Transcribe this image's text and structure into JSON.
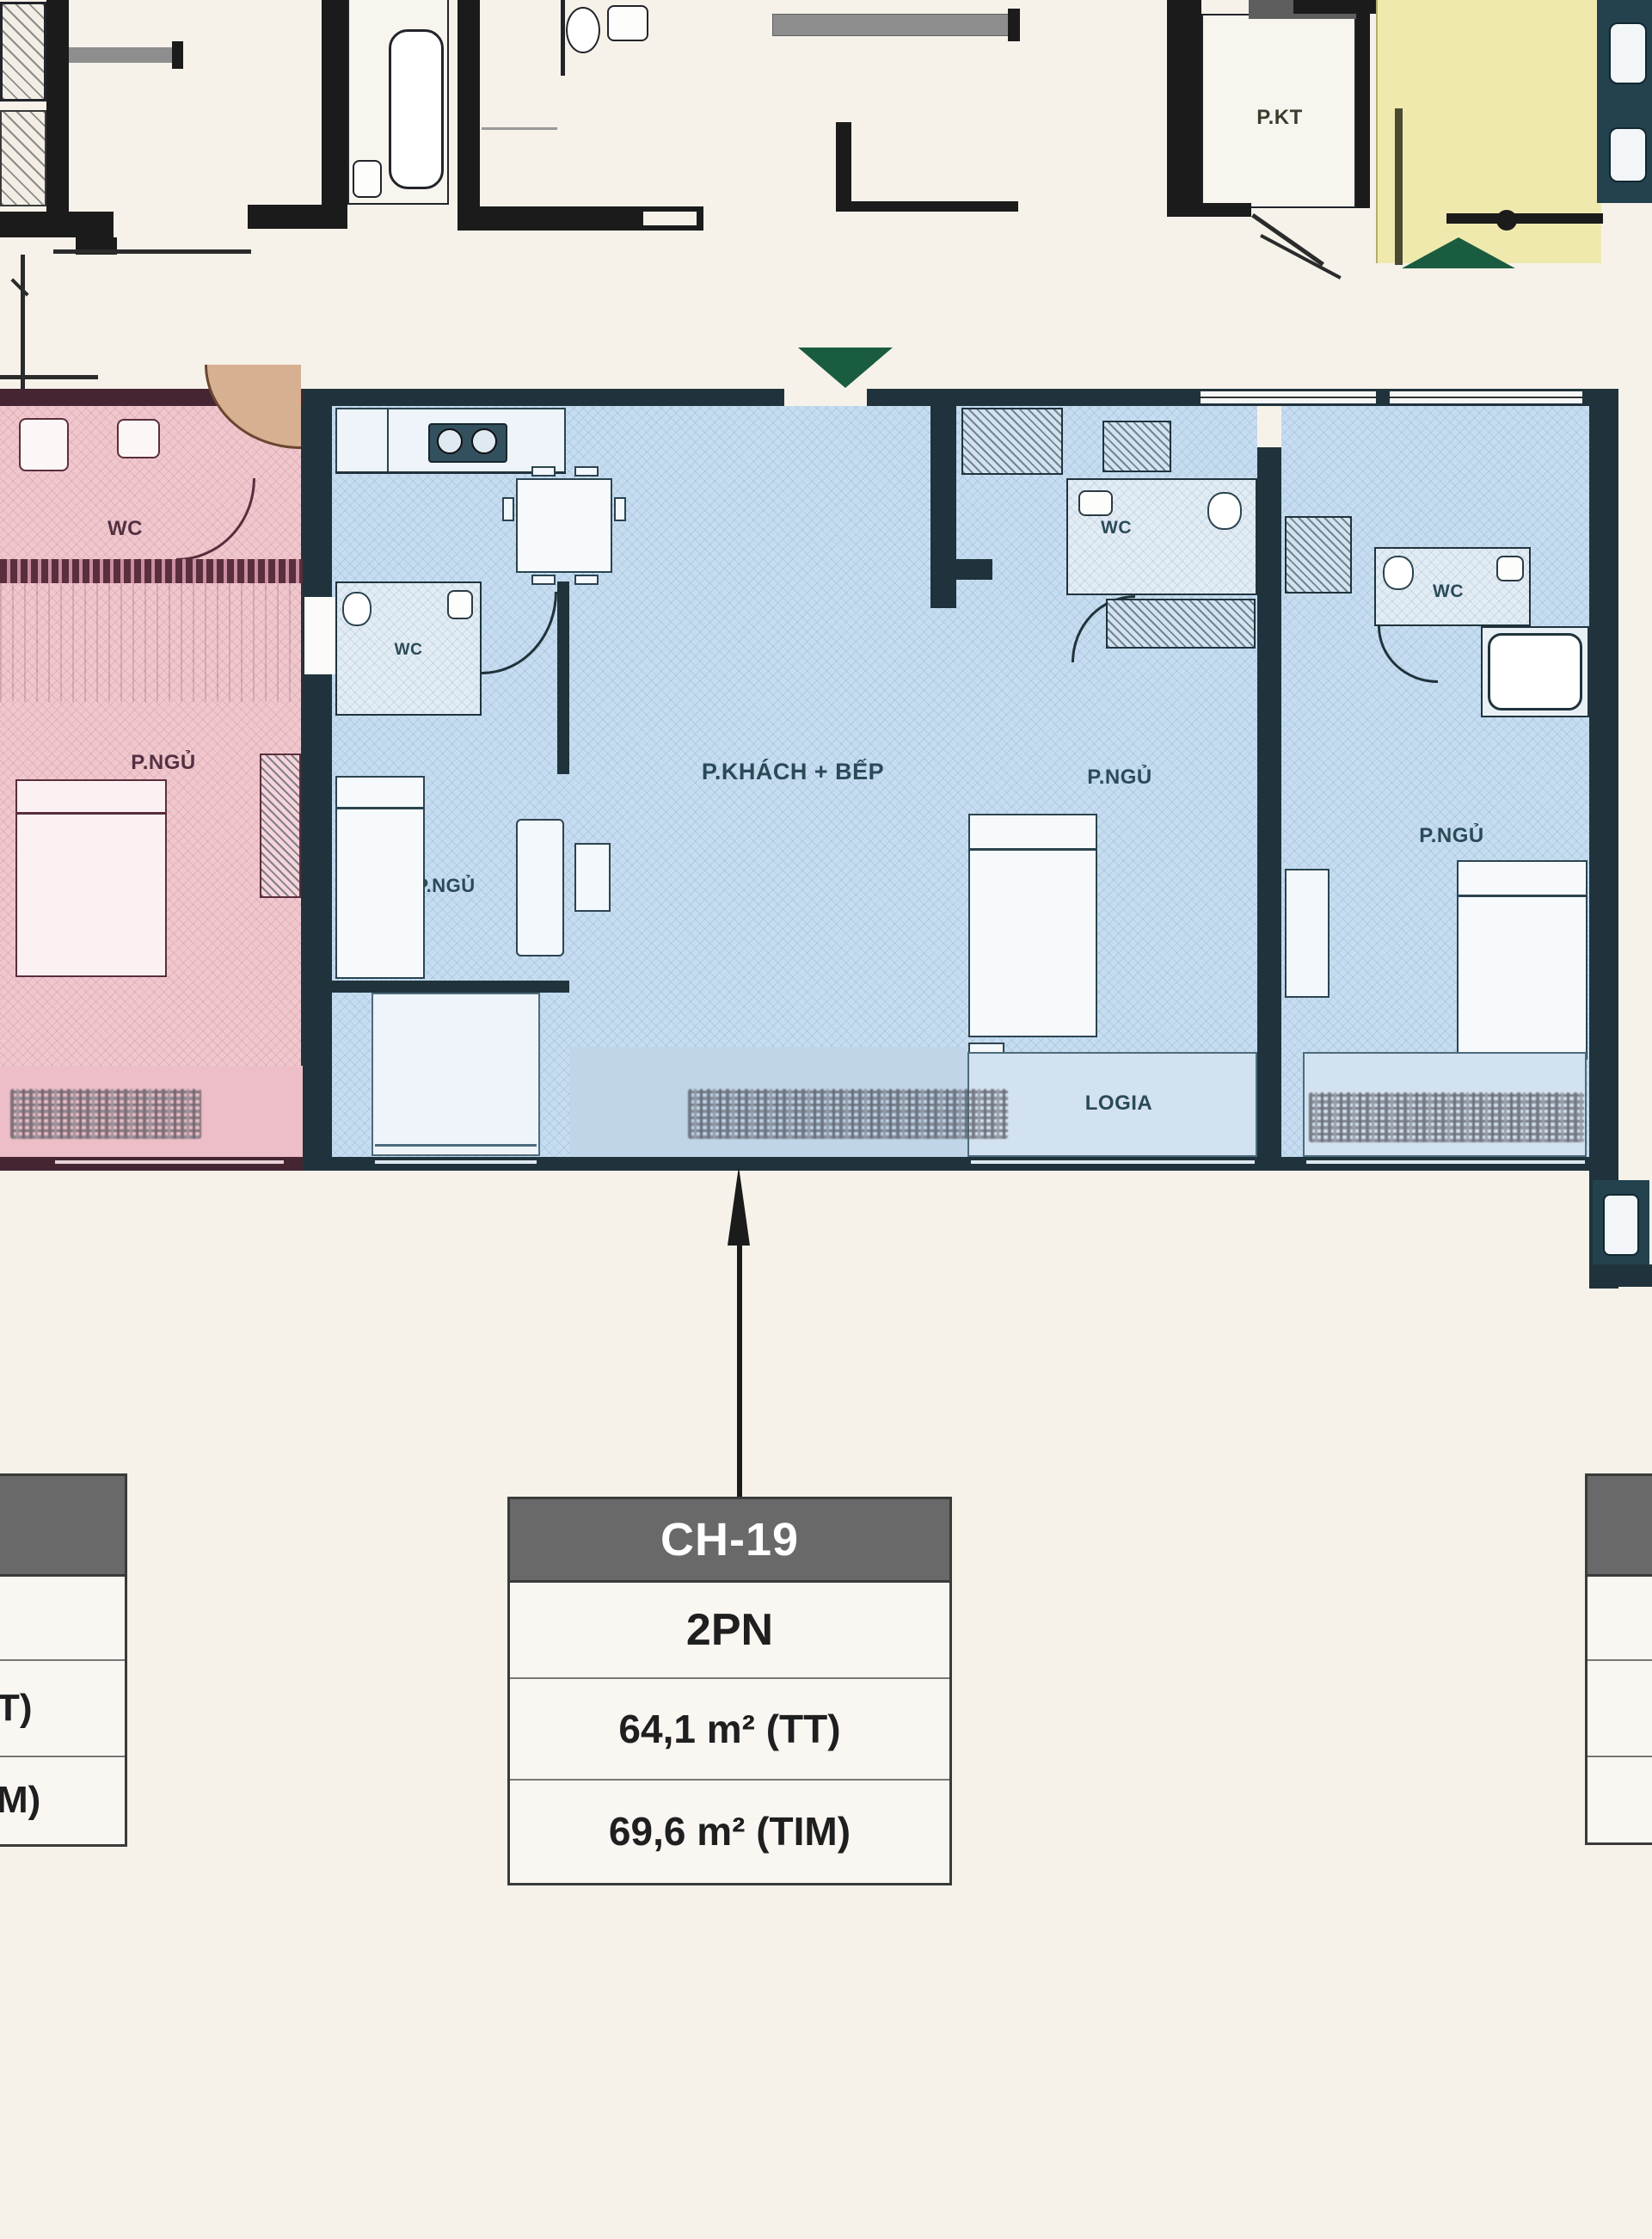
{
  "labels": {
    "wc": "WC",
    "bedroom": "P.NGỦ",
    "living_kitchen": "P.KHÁCH + BẾP",
    "logia": "LOGIA",
    "technical_room": "P.KT"
  },
  "info_table": {
    "unit_code": "CH-19",
    "bedroom_count": "2PN",
    "area_carpet": "64,1 m² (TT)",
    "area_built": "69,6 m² (TIM)"
  },
  "info_table_left_partial": {
    "row_area_carpet": "T)",
    "row_area_built": "M)"
  },
  "colors": {
    "background": "#f6f2ea",
    "unit_pink": "#f0c7cd",
    "unit_blue": "#c6ddf1",
    "unit_yellow": "#efe9ae",
    "wall_dark": "#20333c",
    "wall_maroon": "#452531",
    "marker_green": "#1a5c40",
    "table_header": "#696969"
  },
  "icons": {
    "entrance_main": "green-triangle-down-icon",
    "entrance_upper": "green-triangle-up-icon",
    "unit_pointer": "pin-arrow-icon",
    "appliance": "washer-icon"
  }
}
